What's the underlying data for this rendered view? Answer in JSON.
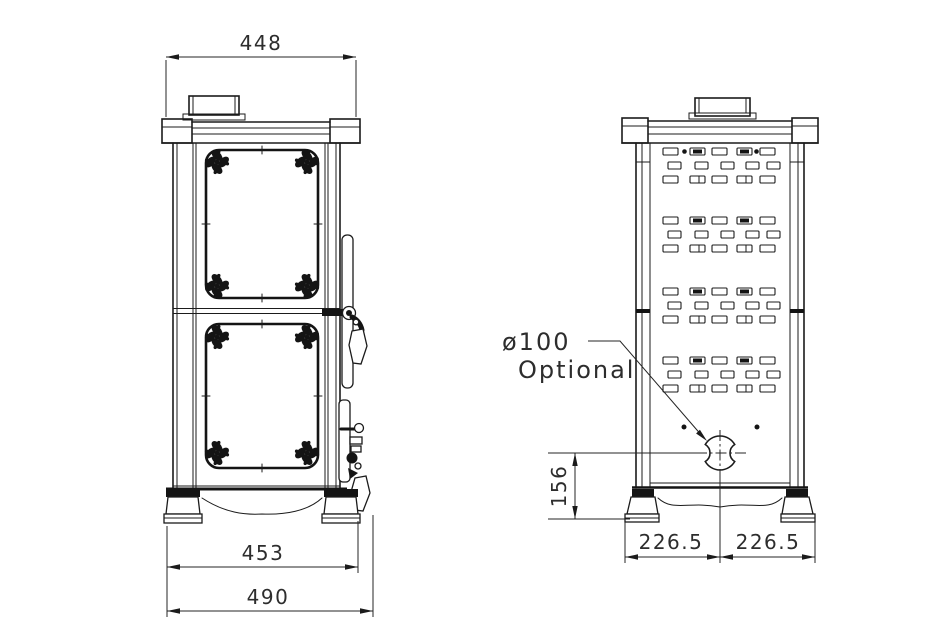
{
  "page": {
    "background": "#ffffff",
    "line_color": "#1b1b1b"
  },
  "front_view": {
    "dims": {
      "top_width": "448",
      "feet_width": "453",
      "overall_width": "490"
    }
  },
  "rear_view": {
    "dims": {
      "outlet_center_height": "156",
      "center_to_left": "226.5",
      "center_to_right": "226.5"
    },
    "flue_outlet": {
      "diameter": "ø100",
      "note": "Optional"
    }
  }
}
